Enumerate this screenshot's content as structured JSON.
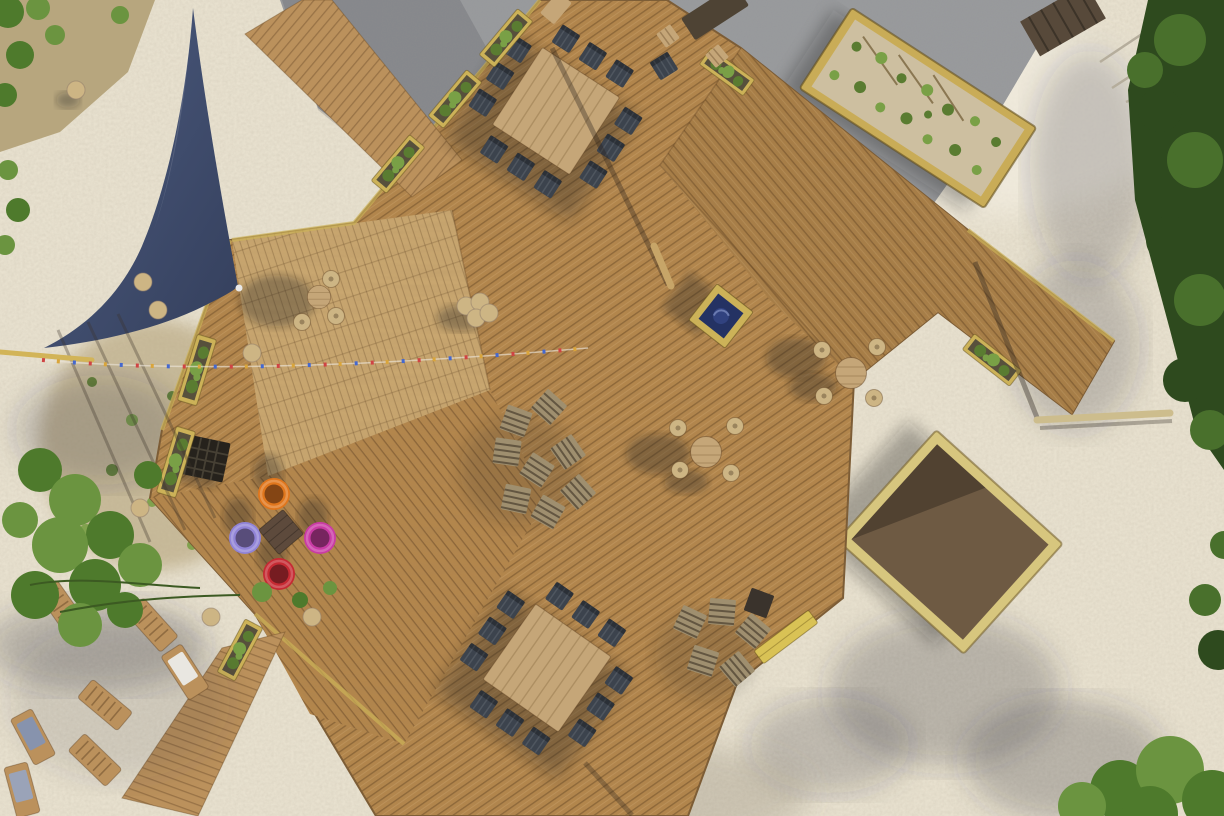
{
  "scene": {
    "title": "Aerial top-down drone photo of a wooden beach-bar deck terrace on white sand",
    "view": "top-down aerial",
    "lighting": "bright sunlight, long shadows cast toward the left",
    "ground_surfaces": [
      "white sand",
      "pine deck planks",
      "grey gravel",
      "dirt with weeds"
    ]
  },
  "colors": {
    "sand": "#e8e1cf",
    "sandBright": "#f3eee1",
    "gravel": "#9a9b9c",
    "deckWood": "#b3864c",
    "deckWoodAlt": "#a87e47",
    "platformWood": "#c9a770",
    "walkwayWood": "#bb915c",
    "tableWood": "#c5a678",
    "chairDark": "#3c434d",
    "stoolTop": "#cdb584",
    "crateWood": "#9f8f6f",
    "planterWood": "#ccb258",
    "plantGreen": "#5a7c31",
    "plantGreenLight": "#79a046",
    "soilDark": "#57503c",
    "bedFrame": "#c9ac57",
    "bedSoil": "#cdbfa0",
    "sandboxFrame": "#d7c67e",
    "sandboxSoil": "#6e5a43",
    "sailBlue": "#4d5c80",
    "sailBlueDark": "#343f5c",
    "poufOrange": "#e0761c",
    "poufLavender": "#9083d6",
    "poufMagenta": "#c93ba4",
    "poufRed": "#c62a33",
    "benchYellow": "#d9c255",
    "fireBlue": "#243263",
    "hedgeGreen": "#2e4a1e",
    "hedgeGreenLight": "#49702c",
    "treeGreen": "#4e7a2c",
    "treeGreenLight": "#6b9440",
    "dirtGround": "#b7a67e",
    "fenceWood": "#57493a",
    "poleWood": "#cdbd8d"
  },
  "inventory": {
    "shade_sail": {
      "shape": "triangular",
      "color": "navy blue",
      "position": "top left"
    },
    "dining_sets": [
      {
        "position": "top center",
        "table": "large square light wood",
        "chairs": 11,
        "chair_color": "dark slate"
      },
      {
        "position": "bottom center",
        "table": "large square light wood",
        "chairs": 11,
        "chair_color": "dark slate"
      }
    ],
    "bar_table_sets": [
      {
        "position": "center right",
        "stools": 4
      },
      {
        "position": "right walkway",
        "stools": 4
      },
      {
        "position": "stage platform",
        "stools": 3
      }
    ],
    "pouf_lounge": {
      "table": "small dark square",
      "pouf_colors": [
        "orange",
        "lavender",
        "magenta",
        "red"
      ]
    },
    "crate_stool_clusters": [
      {
        "position": "center deck",
        "count": 8
      },
      {
        "position": "bottom right of deck",
        "count": 6
      }
    ],
    "stacked_round_stools": {
      "position": "center top of deck",
      "count": 4
    },
    "planter_boxes": 8,
    "garden_bed": {
      "position": "top right on gravel",
      "contents": "rows of young green plants in sandy soil"
    },
    "sandbox": {
      "position": "right on sand",
      "contents": "dark soil"
    },
    "fire_pit_box": {
      "position": "upper center of deck",
      "interior": "deep blue"
    },
    "floor_grate": {
      "position": "left deck edge",
      "color": "black"
    },
    "sun_loungers": {
      "count": 7,
      "fabrics": [
        "wood slats",
        "white cushion",
        "blue fabric"
      ]
    },
    "bunting_line": {
      "flag_colors": [
        "red",
        "blue",
        "yellow"
      ]
    },
    "vegetation": [
      "bushes top left corner",
      "tree lower left",
      "hedge along right edge",
      "shrubs bottom right corner"
    ]
  }
}
